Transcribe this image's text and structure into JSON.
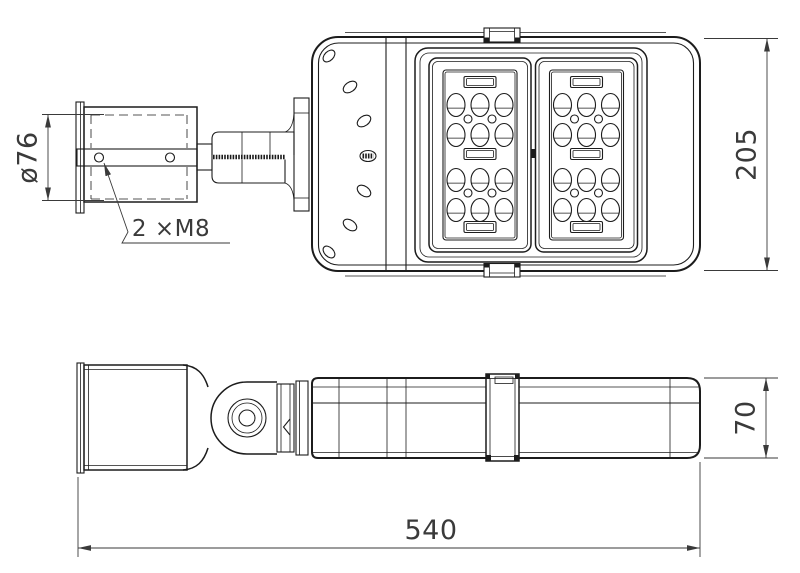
{
  "drawing": {
    "background": "#ffffff",
    "line_color": "#1c1c1c",
    "dim_color": "#3a3a3a",
    "views": [
      {
        "id": "top-view",
        "description": "Top view: pole clamp bracket, hinge arm and luminaire housing with two LED lens modules"
      },
      {
        "id": "side-view",
        "description": "Side view: pole clamp sleeve, pivot joint and luminaire housing with latch"
      }
    ],
    "dimensions": {
      "clamp_bore_diameter": "ø76",
      "mount_hole_callout": "2 ×M8",
      "housing_width": "205",
      "housing_height": "70",
      "overall_length": "540"
    }
  }
}
